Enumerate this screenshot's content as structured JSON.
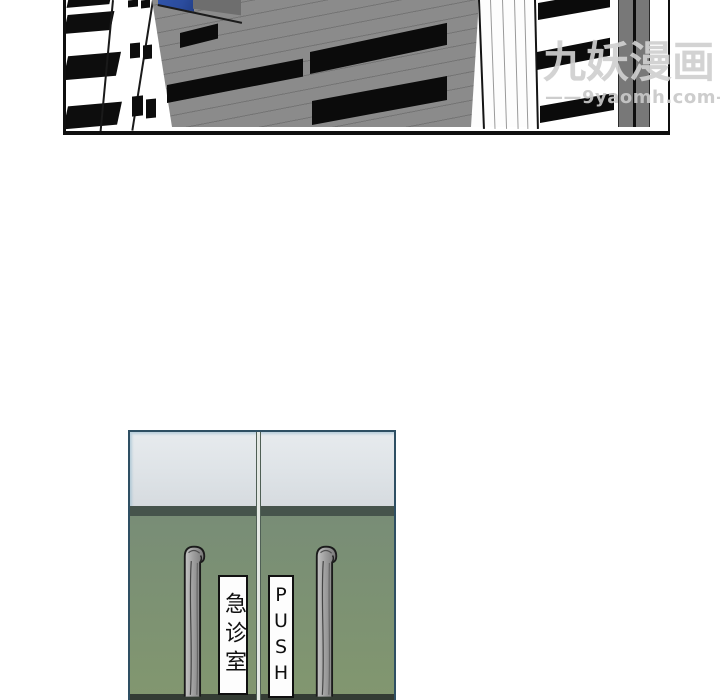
{
  "watermark": {
    "brand": "九妖漫画",
    "site": "——9yaomh.com——"
  },
  "scene": {
    "building": {
      "roof_color": "#2b4c9e",
      "wall_color": "#8b8b8b",
      "window_color": "#0d0d0d"
    },
    "doors": {
      "left_sign_text": "急诊室",
      "right_sign_letters": [
        "P",
        "U",
        "S",
        "H"
      ],
      "frame_color": "#2e4f63",
      "glass_color": "#dde2e6",
      "door_green_top": "#75887a",
      "door_green_bottom": "#82976f"
    }
  }
}
